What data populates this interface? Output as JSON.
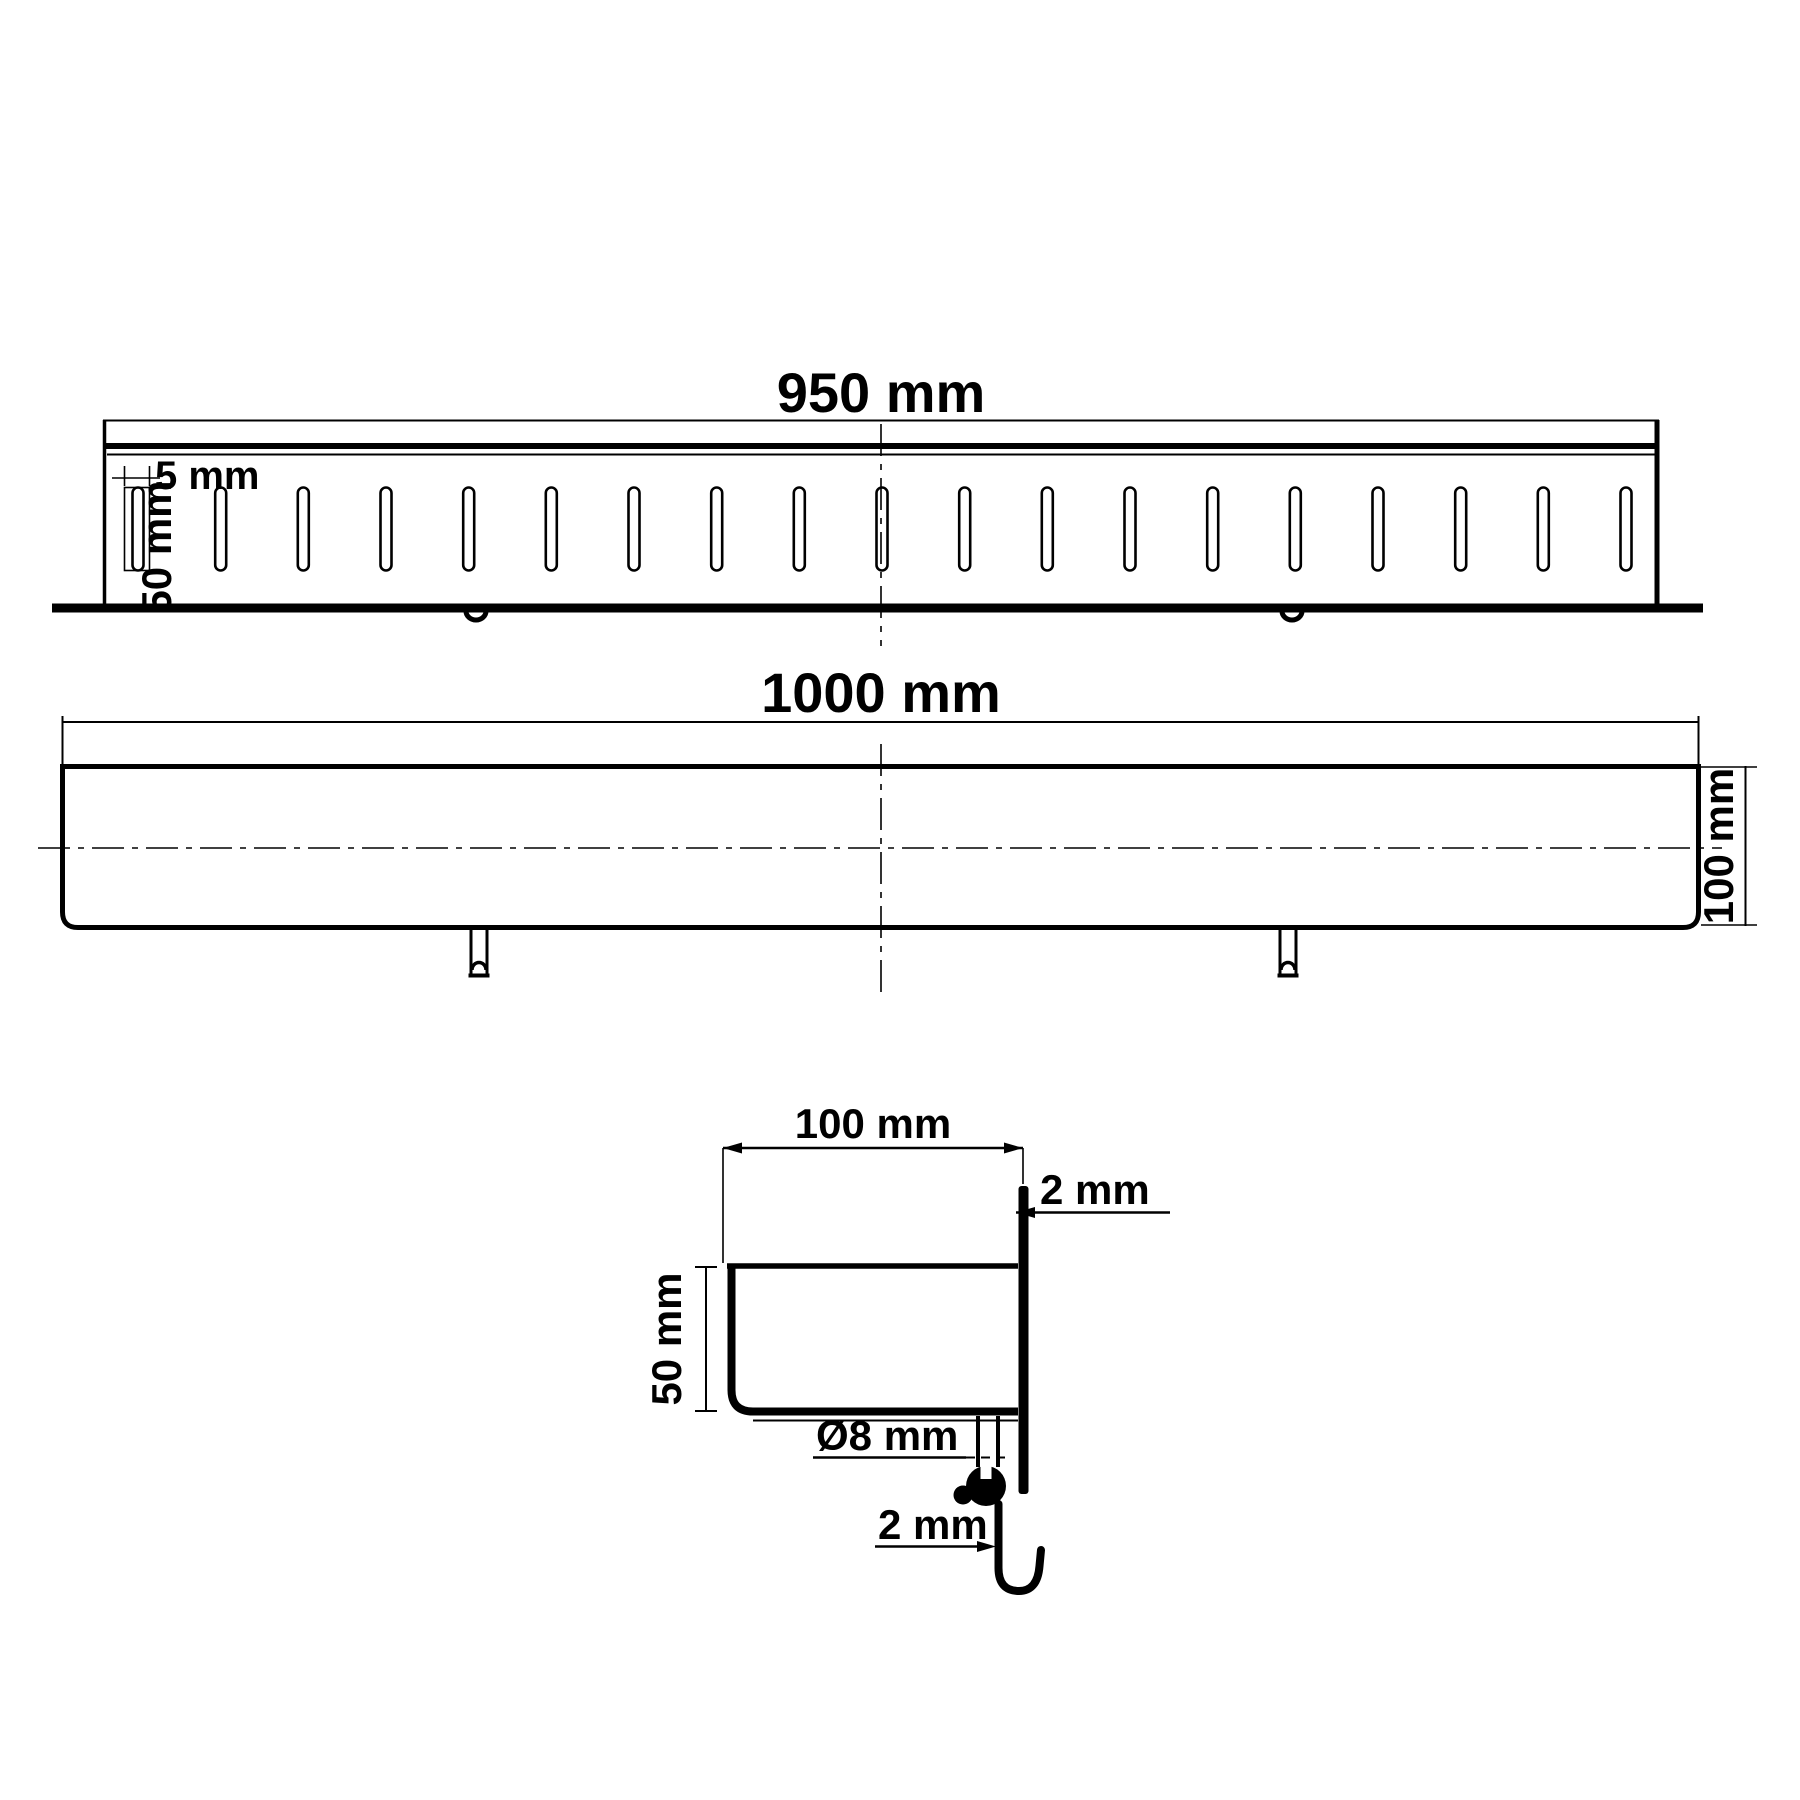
{
  "page": {
    "background": "#ffffff",
    "line_color": "#000000",
    "description": "Technical dimension drawing of a linear drain channel with slotted grate, three views"
  },
  "views": {
    "top": {
      "name": "grate-front-view",
      "length": "950 mm",
      "slot_width": "5 mm",
      "slot_length": "50 mm",
      "slot_count": 19
    },
    "side": {
      "name": "channel-side-view",
      "length": "1000 mm",
      "height": "100 mm"
    },
    "section": {
      "name": "cross-section-view",
      "width": "100 mm",
      "depth": "50 mm",
      "edge_thickness": "2 mm",
      "pin_diameter": "Ø8 mm",
      "hook_thickness": "2 mm"
    }
  }
}
